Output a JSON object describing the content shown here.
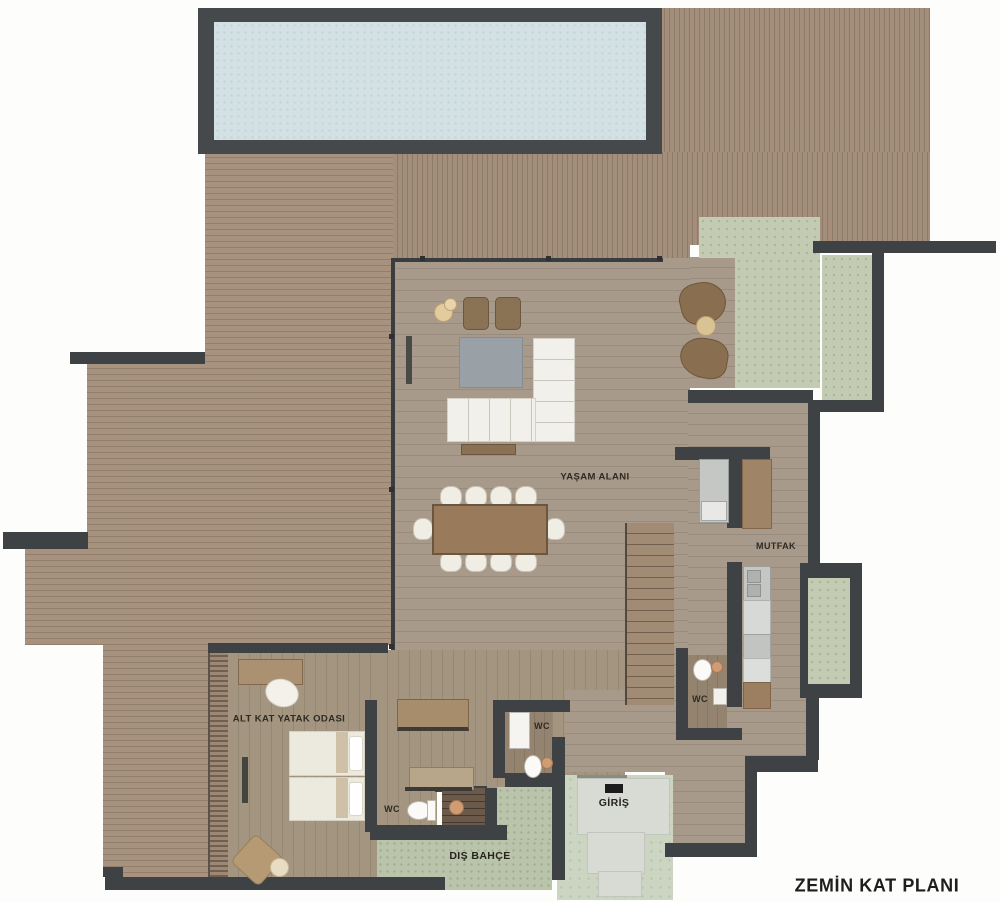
{
  "title": "ZEMİN KAT PLANI",
  "labels": {
    "living_area": "YAŞAM ALANI",
    "kitchen": "MUTFAK",
    "bedroom": "ALT KAT YATAK ODASI",
    "entrance": "GİRİŞ",
    "outdoor_garden": "DIŞ BAHÇE",
    "wc_kitchen": "WC",
    "wc_hall": "WC",
    "wc_ensuite": "WC"
  },
  "features": {
    "pool": "swimming-pool",
    "deck": "wood-deck-terrace",
    "main_stairs": "staircase",
    "garden_stairs": "garden-steps",
    "doormat": "entrance-doormat"
  },
  "colors": {
    "wall": "#3f4244",
    "deck_wood": "#a6927e",
    "interior_wood": "#a89a8a",
    "pool_water": "#d3e1e5",
    "courtyard_green": "#c3cbb2",
    "lawn_green": "#b9c4ab",
    "entry_green": "#ccd4c2",
    "stone_path": "#d8dad4",
    "sofa_white": "#f0ede5",
    "furniture_brown": "#997b5b"
  }
}
